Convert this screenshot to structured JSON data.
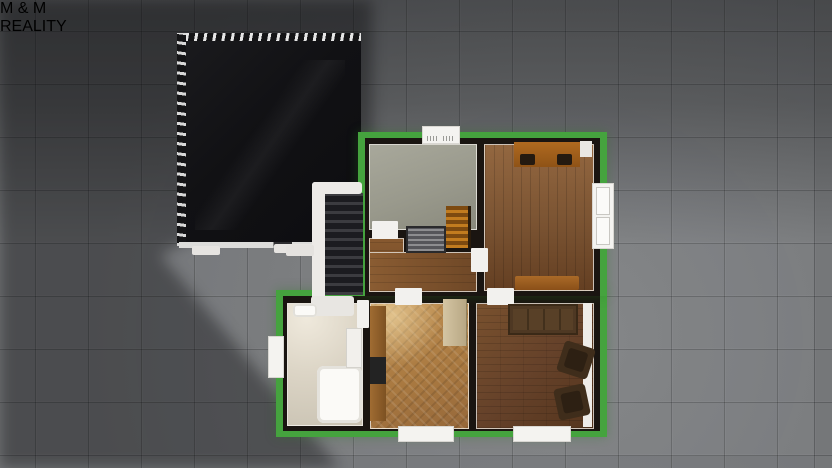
{
  "brand": {
    "m_left": "M",
    "ampersand": "&",
    "m_right": "M",
    "word_bottom": "REALITY",
    "color_red": "#c51f2e",
    "color_blue": "#2980c4",
    "text_color": "#ffffff"
  },
  "palette": {
    "ground_tiles": "#7b7d80",
    "ground_shadow": "#4c4e50",
    "plot_outline_green": "#45a33e",
    "wall_black": "#1a1511",
    "roof_black": "#121214",
    "roof_trim_white": "#e5e5e5",
    "plank_wood_floor": "#7a5332",
    "herringbone_wood_floor": "#a87840",
    "dark_wood_floor": "#66422a",
    "gray_room_floor": "#99998c",
    "bathroom_floor": "#dcd5c6",
    "fixture_white": "#f2f1ee",
    "interior_stairs_wood": "#c27c1f"
  },
  "scene": {
    "description": "Top-down 3D render of a house storey floor plan outlined in green on gray paving, beside a black roof of an adjacent wing with an exterior staircase between them; M&M Reality logo top right.",
    "rooms": [
      {
        "id": "gray-room"
      },
      {
        "id": "bedroom"
      },
      {
        "id": "hallway"
      },
      {
        "id": "stairwell"
      },
      {
        "id": "bathroom"
      },
      {
        "id": "kitchen"
      },
      {
        "id": "living-room"
      }
    ]
  }
}
